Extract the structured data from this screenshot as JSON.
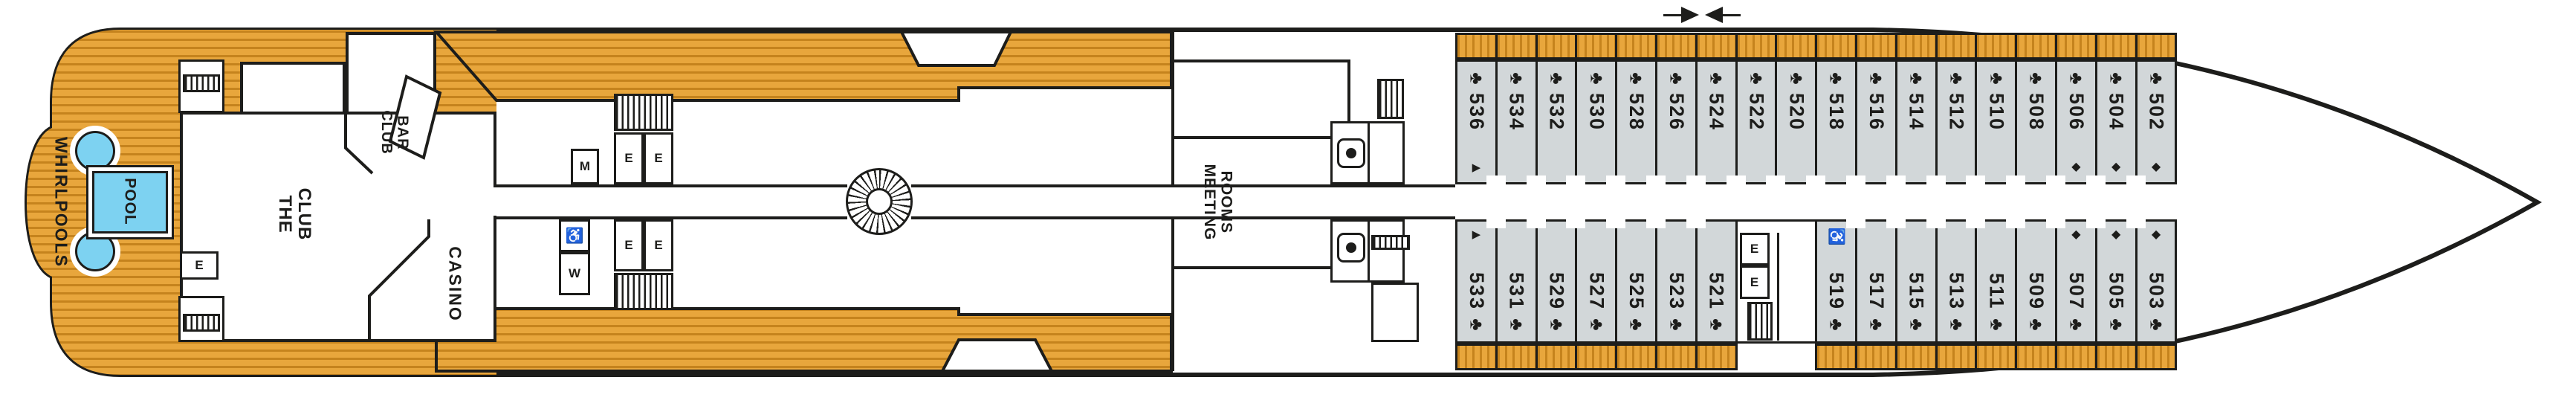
{
  "plan": {
    "labels": {
      "whirlpools": "WHIRLPOOLS",
      "pool": "POOL",
      "the_club": [
        "THE",
        "CLUB"
      ],
      "club_bar": [
        "CLUB",
        "BAR"
      ],
      "casino": "CASINO",
      "meeting_rooms": [
        "MEETING",
        "ROOMS"
      ],
      "restroom_men": "M",
      "restroom_women": "W",
      "elevator": "E"
    },
    "icons": {
      "club": "♣",
      "diamond": "◆",
      "triangle": "▶",
      "wheelchair": "♿"
    },
    "colors": {
      "wood": "#E8A63C",
      "wood_stripe": "#C5831D",
      "cabin_fill": "#D2D7D9",
      "pool_fill": "#7DD2F1",
      "line": "#1D1D1B"
    }
  },
  "cabins": {
    "top": [
      {
        "number": "536",
        "features": [
          "triangle"
        ]
      },
      {
        "number": "534",
        "features": []
      },
      {
        "number": "532",
        "features": []
      },
      {
        "number": "530",
        "features": []
      },
      {
        "number": "528",
        "features": []
      },
      {
        "number": "526",
        "features": []
      },
      {
        "number": "524",
        "features": []
      },
      {
        "number": "522",
        "features": []
      },
      {
        "number": "520",
        "features": []
      },
      {
        "number": "518",
        "features": []
      },
      {
        "number": "516",
        "features": []
      },
      {
        "number": "514",
        "features": []
      },
      {
        "number": "512",
        "features": []
      },
      {
        "number": "510",
        "features": []
      },
      {
        "number": "508",
        "features": []
      },
      {
        "number": "506",
        "features": [
          "diamond"
        ]
      },
      {
        "number": "504",
        "features": [
          "diamond"
        ]
      },
      {
        "number": "502",
        "features": [
          "diamond"
        ]
      }
    ],
    "bottom": [
      {
        "number": "533",
        "features": [
          "triangle"
        ]
      },
      {
        "number": "531",
        "features": []
      },
      {
        "number": "529",
        "features": []
      },
      {
        "number": "527",
        "features": []
      },
      {
        "number": "525",
        "features": []
      },
      {
        "number": "523",
        "features": []
      },
      {
        "number": "521",
        "features": []
      },
      {
        "number": "519",
        "features": [
          "wheelchair"
        ]
      },
      {
        "number": "517",
        "features": []
      },
      {
        "number": "515",
        "features": []
      },
      {
        "number": "513",
        "features": []
      },
      {
        "number": "511",
        "features": []
      },
      {
        "number": "509",
        "features": []
      },
      {
        "number": "507",
        "features": [
          "diamond"
        ]
      },
      {
        "number": "505",
        "features": [
          "diamond"
        ]
      },
      {
        "number": "503",
        "features": [
          "diamond"
        ]
      }
    ]
  }
}
